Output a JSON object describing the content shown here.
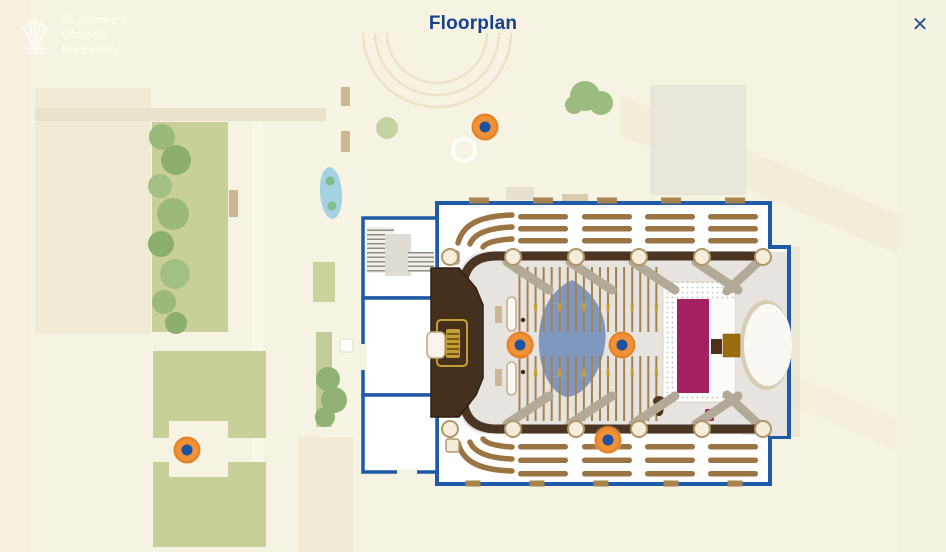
{
  "header": {
    "title": "Floorplan",
    "close_label": "✕"
  },
  "logo": {
    "line1": "St James's",
    "line2": "Church",
    "line3": "Piccadilly"
  },
  "colors": {
    "background": "#f7f3e3",
    "title_blue": "#15418f",
    "wall_blue": "#1e5aa7",
    "wall_brown": "#4b3523",
    "pew_brown": "#9b7443",
    "nave_floor": "#e7e4df",
    "marker_orange": "#f19137",
    "marker_blue": "#1d52a0",
    "carpet_magenta": "#a32160",
    "altar_gold": "#9e6c10",
    "organ_brown": "#45301e",
    "organ_gold": "#c59f35",
    "lawn_green": "#c9cf98",
    "tree_green": "#94b577",
    "pond_blue": "#a5d2e3",
    "cone_blue": "#8097bf"
  },
  "map": {
    "markers": [
      {
        "id": "courtyard",
        "x": 485,
        "y": 127
      },
      {
        "id": "nave-west",
        "x": 520,
        "y": 345
      },
      {
        "id": "nave-east",
        "x": 622,
        "y": 345
      },
      {
        "id": "south-gallery",
        "x": 608,
        "y": 440
      },
      {
        "id": "garden",
        "x": 187,
        "y": 450
      }
    ]
  }
}
